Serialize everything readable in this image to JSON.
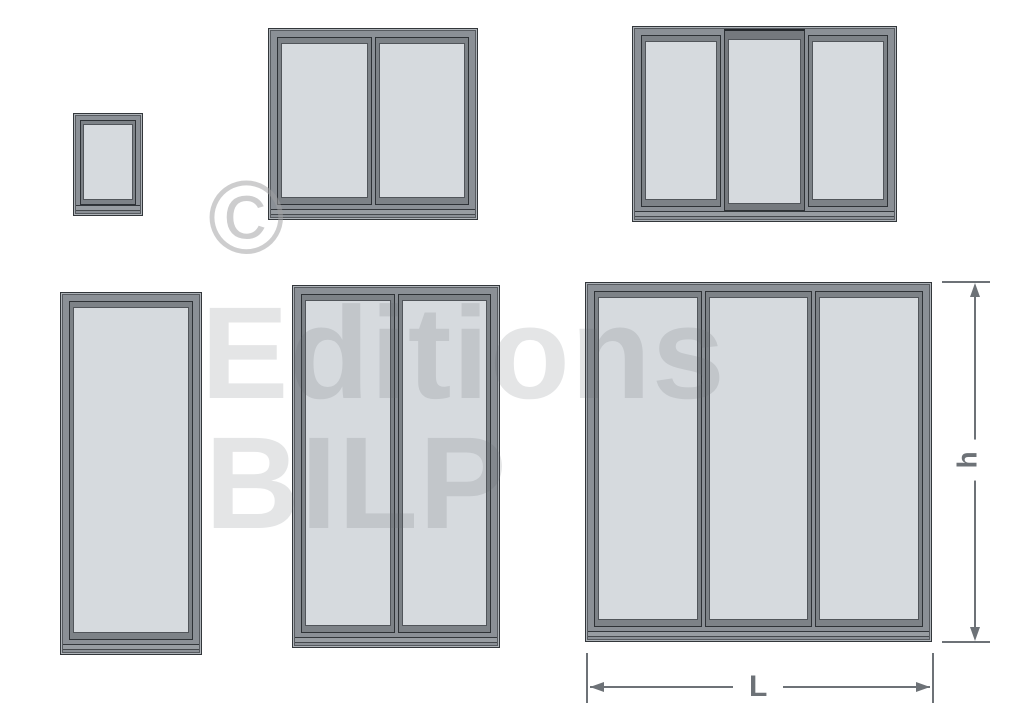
{
  "watermark": {
    "symbol": "©",
    "line1": "Editions",
    "line2": "BILP"
  },
  "dimensions": {
    "height_label": "h",
    "width_label": "L"
  },
  "windows": [
    {
      "id": "single-small",
      "panes": 1
    },
    {
      "id": "double-small",
      "panes": 2
    },
    {
      "id": "triple-small",
      "panes": 3,
      "raised_pane": "middle"
    },
    {
      "id": "single-tall",
      "panes": 1
    },
    {
      "id": "double-tall",
      "panes": 2
    },
    {
      "id": "triple-large",
      "panes": 3
    }
  ],
  "colors": {
    "background": "#ffffff",
    "frame": "#8b9096",
    "frame_outline": "#33373b",
    "frame_highlight": "#aeb3b8",
    "glass": "#d6dade",
    "dimension_lines": "#6d7277",
    "watermark_text": "rgba(93,98,104,0.17)",
    "watermark_symbol": "rgba(160,160,162,0.52)"
  }
}
